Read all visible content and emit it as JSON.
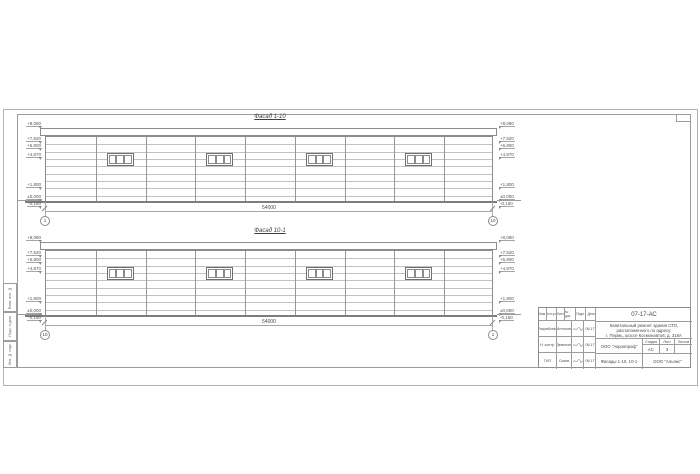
{
  "sheet": {
    "side_labels": [
      "Взам. инв. №",
      "Подп. и дата",
      "Инв. № подл."
    ]
  },
  "facades": [
    {
      "title": "Фасад 1-10",
      "dimension": "54000",
      "left_bubble": "1",
      "right_bubble": "10",
      "levels": [
        "+8,080",
        "+7,520",
        "+6,800",
        "+4,870",
        "+1,800",
        "±0,000",
        "-0,150"
      ]
    },
    {
      "title": "Фасад 10-1",
      "dimension": "54000",
      "left_bubble": "10",
      "right_bubble": "1",
      "levels": [
        "+8,080",
        "+7,520",
        "+6,800",
        "+4,870",
        "+1,800",
        "±0,000",
        "-0,150"
      ]
    }
  ],
  "titleblock": {
    "designation": "07-17-АС",
    "description_lines": [
      "Капитальный ремонт здания СТО,",
      "расположенного по адресу:",
      "г. Пермь, шоссе Космонавтов, д. 318А"
    ],
    "columns": [
      "Изм.",
      "Кол.уч.",
      "Лист",
      "№ док.",
      "Подп.",
      "Дата"
    ],
    "rows": [
      {
        "role": "Разработал",
        "name": "Антонов",
        "date": "06.17"
      },
      {
        "role": "Н. контр.",
        "name": "Девяткин",
        "date": "06.17"
      },
      {
        "role": "ГИП",
        "name": "Сизов",
        "date": "06.17"
      }
    ],
    "org_design": "ООО \"Акронпроф\"",
    "stage_label": "Стадия",
    "sheet_label": "Лист",
    "sheets_label": "Листов",
    "stage": "АС",
    "sheet_no": "3",
    "sheets_total": "",
    "sheet_title": "Фасады 1-10, 10-1",
    "org": "ООО \"Альянс\""
  }
}
